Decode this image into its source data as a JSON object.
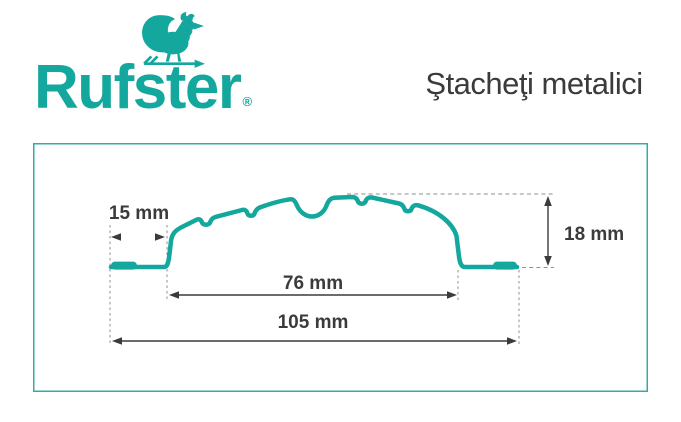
{
  "header": {
    "logo": {
      "text": "Rufster",
      "registered_mark": "®",
      "icon": "rooster-weathervane-icon"
    },
    "title": "Ştacheţi metalici"
  },
  "colors": {
    "brand_teal": "#14A79E",
    "ink": "#3B3B3B",
    "guide_gray": "#8F8F8F",
    "background": "#FFFFFF"
  },
  "diagram": {
    "type": "profile-cross-section drawing",
    "dimensions": {
      "foot_width": {
        "label": "15 mm",
        "value_mm": 15
      },
      "height": {
        "label": "18 mm",
        "value_mm": 18
      },
      "inner_width": {
        "label": "76 mm",
        "value_mm": 76
      },
      "overall_width": {
        "label": "105 mm",
        "value_mm": 105
      }
    }
  }
}
